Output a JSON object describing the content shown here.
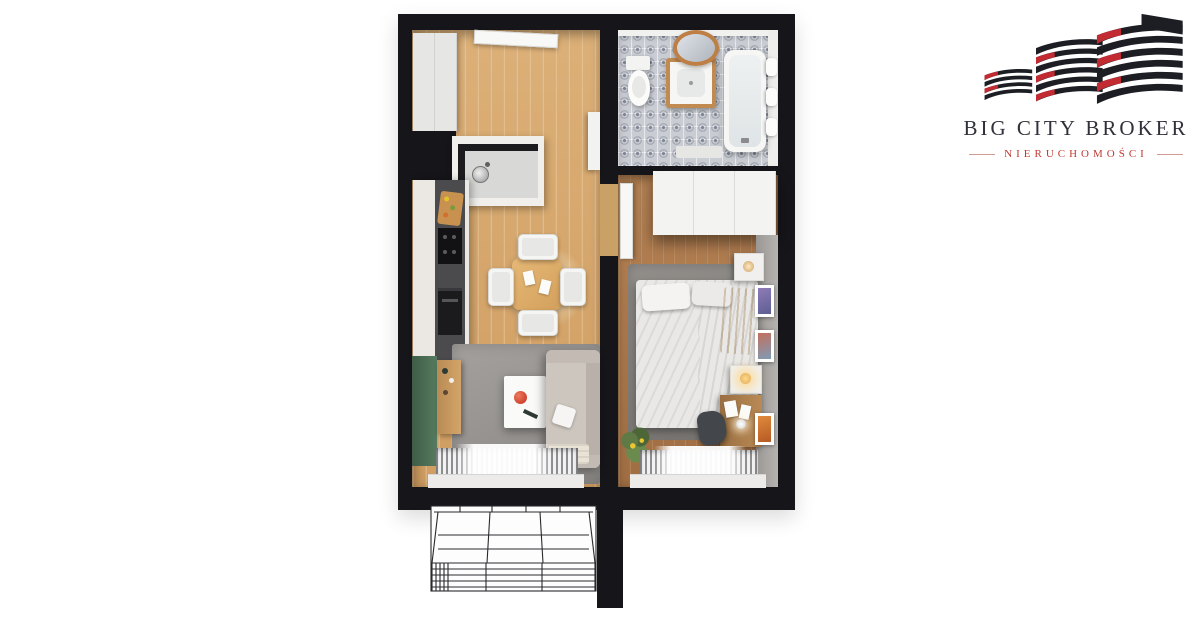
{
  "brand": {
    "name": "BIG CITY BROKER",
    "tagline": "NIERUCHOMOŚCI",
    "name_color": "#30313a",
    "tagline_color": "#bf3a32",
    "building_color": "#1d1e24",
    "building_accent": "#c22b31"
  },
  "floorplan": {
    "style": "top-down 3D apartment render, no text labels",
    "wall_color": "#15151a",
    "rooms": [
      {
        "id": "hallway",
        "floor": "light-oak",
        "objects": [
          "wardrobe",
          "entry-door"
        ]
      },
      {
        "id": "kitchen",
        "floor": "light-oak",
        "objects": [
          "l-shaped-counter",
          "sink",
          "faucet",
          "cutting-board",
          "cooktop",
          "oven",
          "tall-cabinet",
          "dining-table",
          "four-chairs",
          "pendant-light-glow"
        ]
      },
      {
        "id": "living-area",
        "floor": "light-oak",
        "objects": [
          "green-accent-wall",
          "wood-sideboard",
          "gray-rug",
          "white-coffee-table",
          "red-bowl",
          "beige-sofa",
          "white-pillow",
          "blanket",
          "window-radiator",
          "sheer-curtain",
          "window-sill"
        ]
      },
      {
        "id": "bathroom",
        "floor": "patterned-gray-tile",
        "objects": [
          "toilet",
          "vanity-with-sink",
          "round-copper-mirror",
          "bathtub",
          "towel-shelf",
          "bath-mat"
        ]
      },
      {
        "id": "bedroom",
        "floor": "dark-oak",
        "objects": [
          "open-door",
          "white-wardrobe",
          "gray-rug",
          "double-bed",
          "pillows",
          "yellow-throw",
          "nightstand-with-lamp",
          "nightstand-with-glowing-lamp",
          "desk",
          "desk-lamp",
          "desk-chair",
          "papers",
          "three-wall-art-frames",
          "potted-plant",
          "window-radiator",
          "sheer-curtain",
          "window-sill"
        ]
      },
      {
        "id": "balcony",
        "style": "unrendered-line-art",
        "objects": [
          "railing",
          "floor-grid"
        ]
      }
    ],
    "palette": {
      "light_wood": "#d7a76c",
      "dark_wood": "#ad7a4d",
      "green_wall": "#4e6e55",
      "rug_gray": "#9a9794",
      "sofa_beige": "#cdc6bf",
      "red_bowl": "#c22d1e",
      "yellow_throw": "#e8a41f",
      "tile_gray": "#c9ccd2",
      "copper_mirror": "#bd7f46"
    }
  }
}
